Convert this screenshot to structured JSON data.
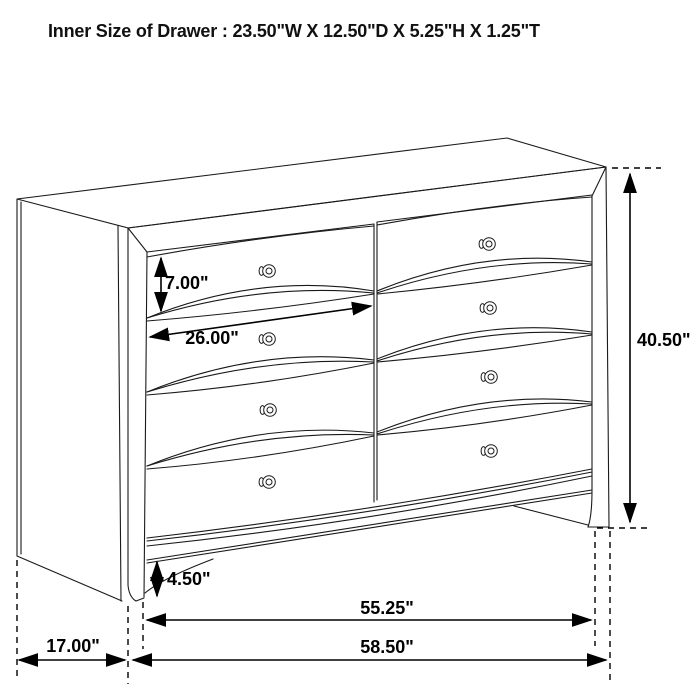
{
  "title": "Inner Size of Drawer : 23.50\"W X 12.50\"D X 5.25\"H X 1.25\"T",
  "dimensions": {
    "drawer_height": "7.00\"",
    "drawer_width": "26.00\"",
    "overall_height": "40.50\"",
    "base_height": "4.50\"",
    "base_width": "55.25\"",
    "depth": "17.00\"",
    "overall_width": "58.50\""
  }
}
